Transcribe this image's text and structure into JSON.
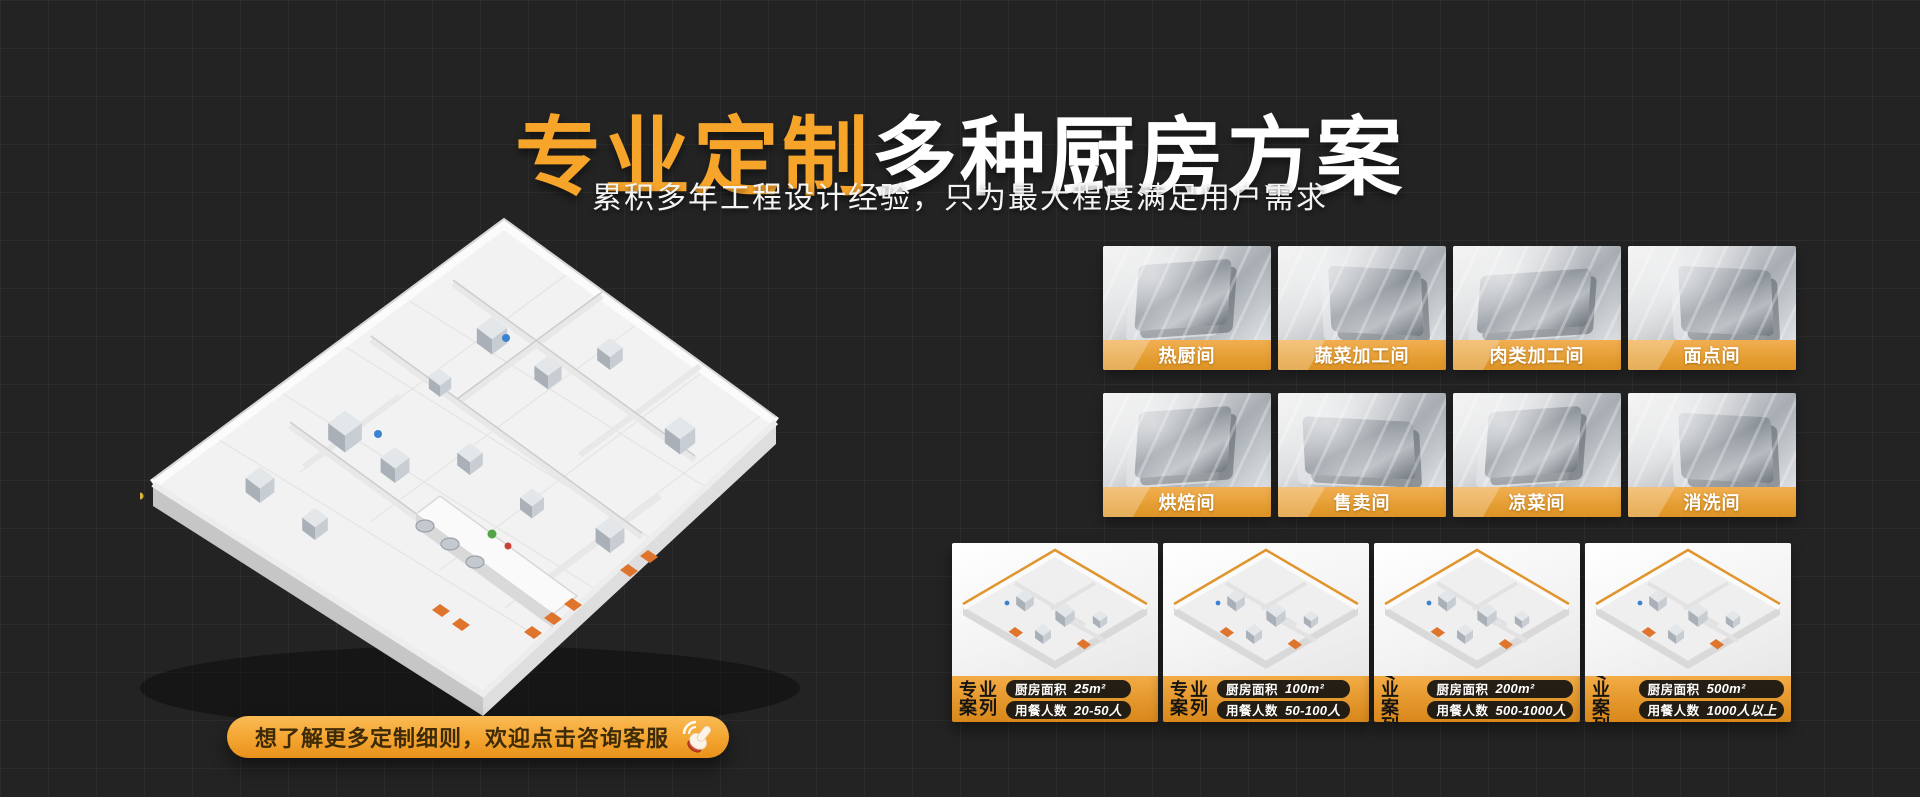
{
  "page": {
    "bg": "#232323",
    "grid_line": "#2e2e2f",
    "accent_orange": "#F6A42A",
    "label_bar_top": "#F1AF52",
    "label_bar_bottom": "#DD9325"
  },
  "hero": {
    "title_highlight": "专业定制",
    "title_rest": "多种厨房方案",
    "subtitle": "累积多年工程设计经验，只为最大程度满足用户需求"
  },
  "floorplan": {
    "description": "isometric-3d-kitchen-floorplan"
  },
  "cta": {
    "label": "想了解更多定制细则，欢迎点击咨询客服",
    "icon": "hand-click-icon"
  },
  "rooms": [
    {
      "label": "热厨间"
    },
    {
      "label": "蔬菜加工间"
    },
    {
      "label": "肉类加工间"
    },
    {
      "label": "面点间"
    },
    {
      "label": "烘焙间"
    },
    {
      "label": "售卖间"
    },
    {
      "label": "凉菜间"
    },
    {
      "label": "消洗间"
    }
  ],
  "case_common": {
    "tag_line1": "专业",
    "tag_line2": "案列",
    "area_label": "厨房面积",
    "diners_label": "用餐人数"
  },
  "cases": [
    {
      "area_value": "25m²",
      "diners_value": "20-50人"
    },
    {
      "area_value": "100m²",
      "diners_value": "50-100人"
    },
    {
      "area_value": "200m²",
      "diners_value": "500-1000人"
    },
    {
      "area_value": "500m²",
      "diners_value": "1000人以上"
    }
  ]
}
